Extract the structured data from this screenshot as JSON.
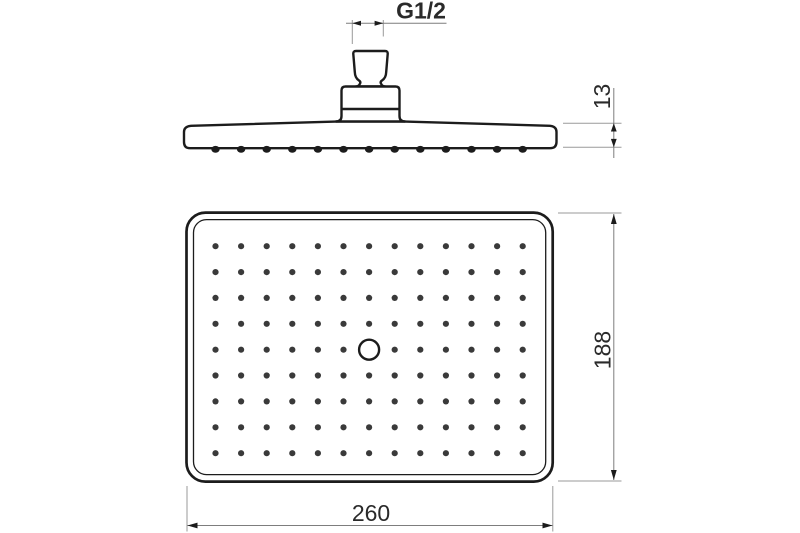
{
  "drawing": {
    "background": "#ffffff",
    "line_color": "#1c1c1c",
    "dim_line_color": "#7d7d7d",
    "ext_line_color": "#9a9a9a",
    "text_color": "#2a2a2a",
    "dot_color": "#3a3a3a"
  },
  "dimensions": {
    "thread_label": "G1/2",
    "profile_thickness": "13",
    "face_height": "188",
    "face_width": "260"
  },
  "face_view": {
    "nozzle_columns": 13,
    "nozzle_rows": 9,
    "has_center_outlet": true
  },
  "side_view": {
    "nozzle_bumps": 13
  }
}
